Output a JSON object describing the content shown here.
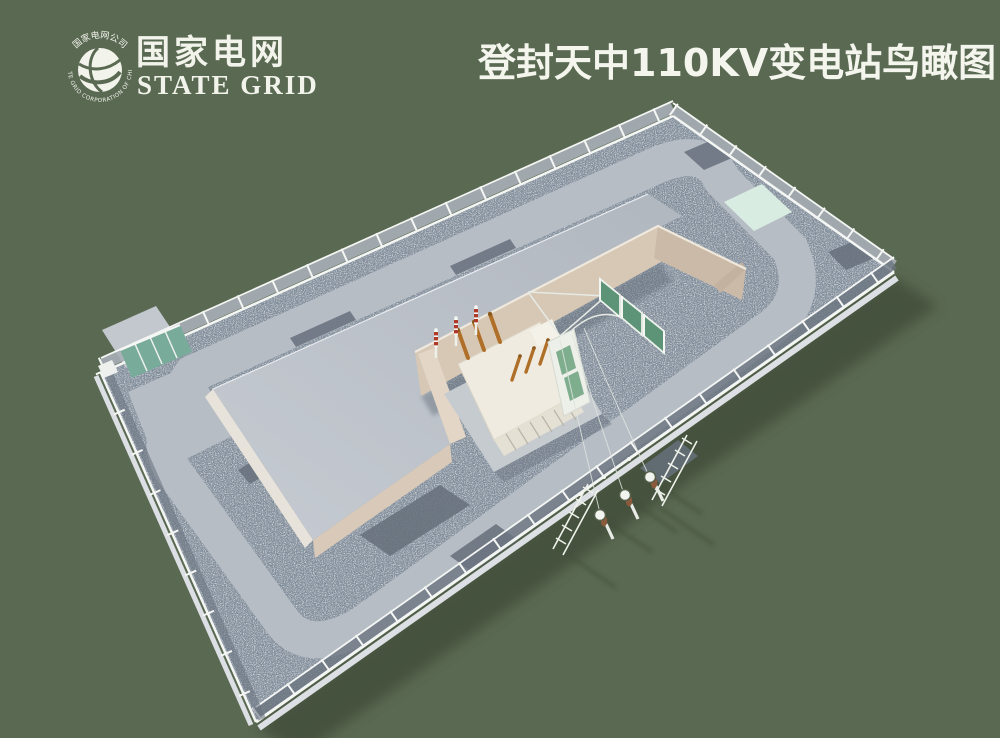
{
  "page": {
    "background": "#5a6952"
  },
  "brand": {
    "emblem_icon": "state-grid-globe-emblem",
    "emblem_ring_text_top": "国家电网公司",
    "emblem_ring_text_bottom": "STATE GRID CORPORATION OF CHINA",
    "name_cn": "国家电网",
    "name_en": "STATE GRID",
    "text_color": "#f2f4ec"
  },
  "title": {
    "text": "登封天中110KV变电站鸟瞰图",
    "color": "#f4f6ee"
  },
  "scene": {
    "kind": "3d-aerial-render",
    "objects": [
      "perimeter-fence",
      "gravel-yard",
      "ring-road",
      "main-control-building",
      "transformer-bay-firewall",
      "main-transformer",
      "surge-arresters",
      "bushings",
      "blast-screens",
      "gantry-frame",
      "entrance-gate",
      "equipment-pads",
      "terminal-poles",
      "lattice-supports",
      "power-lines"
    ],
    "colors": {
      "background": "#5a6952",
      "shadow": "#42503c",
      "gravel": "#8a95a1",
      "road": "#b7bdc5",
      "roof": "#bdc3ca",
      "wall_beige": "#d7c7b5",
      "wall_light": "#e7e3da",
      "fence_white": "#f4f6f4",
      "fence_mesh": "#a8afb7",
      "gate_teal": "#79ab9a",
      "pad_mint": "#d9ece1",
      "pad_dark": "#66707b",
      "transformer_ivory": "#efebe0",
      "bushing_orange": "#b06f28",
      "arrester_red": "#b03a2a",
      "screen_green": "#5d9377",
      "pole_white": "#e9ece6",
      "insulator_brown": "#8a5a3c"
    }
  }
}
